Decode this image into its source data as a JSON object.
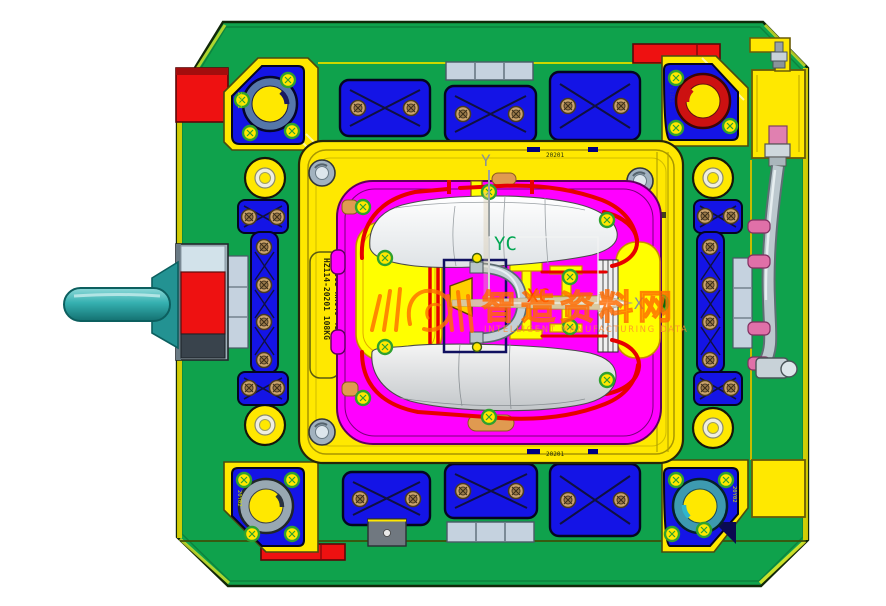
{
  "labels": {
    "yc": "YC",
    "xc": "XC",
    "axis_x": "X",
    "axis_y": "Y"
  },
  "plate_tag": {
    "line1": "HZ114-20201 108KG",
    "line2": "1.2083-HRC46-48"
  },
  "stamps": {
    "plate_top": "20201",
    "plate_bottom": "20201",
    "guide_tl": "20Y01",
    "guide_tr": "19161",
    "guide_bl": "20Y02",
    "guide_br": "20Y02"
  },
  "watermark": {
    "title": "智造资料网",
    "subtitle": "INTELLIGENT MANUFACTURING DATA"
  },
  "colors": {
    "base_green": "#0FA24C",
    "plate_yellow": "#FFE800",
    "pocket_yellow": "#FFFF00",
    "insert_magenta": "#FF00FF",
    "pad_blue": "#1414E6",
    "cooling_red": "#E60000",
    "handle_cyan": "#35B0B0",
    "watermark_orange": "#FF7000",
    "yc_green": "#00A651",
    "xc_red": "#FF3300",
    "metal_gray": "#B6C2C8"
  }
}
